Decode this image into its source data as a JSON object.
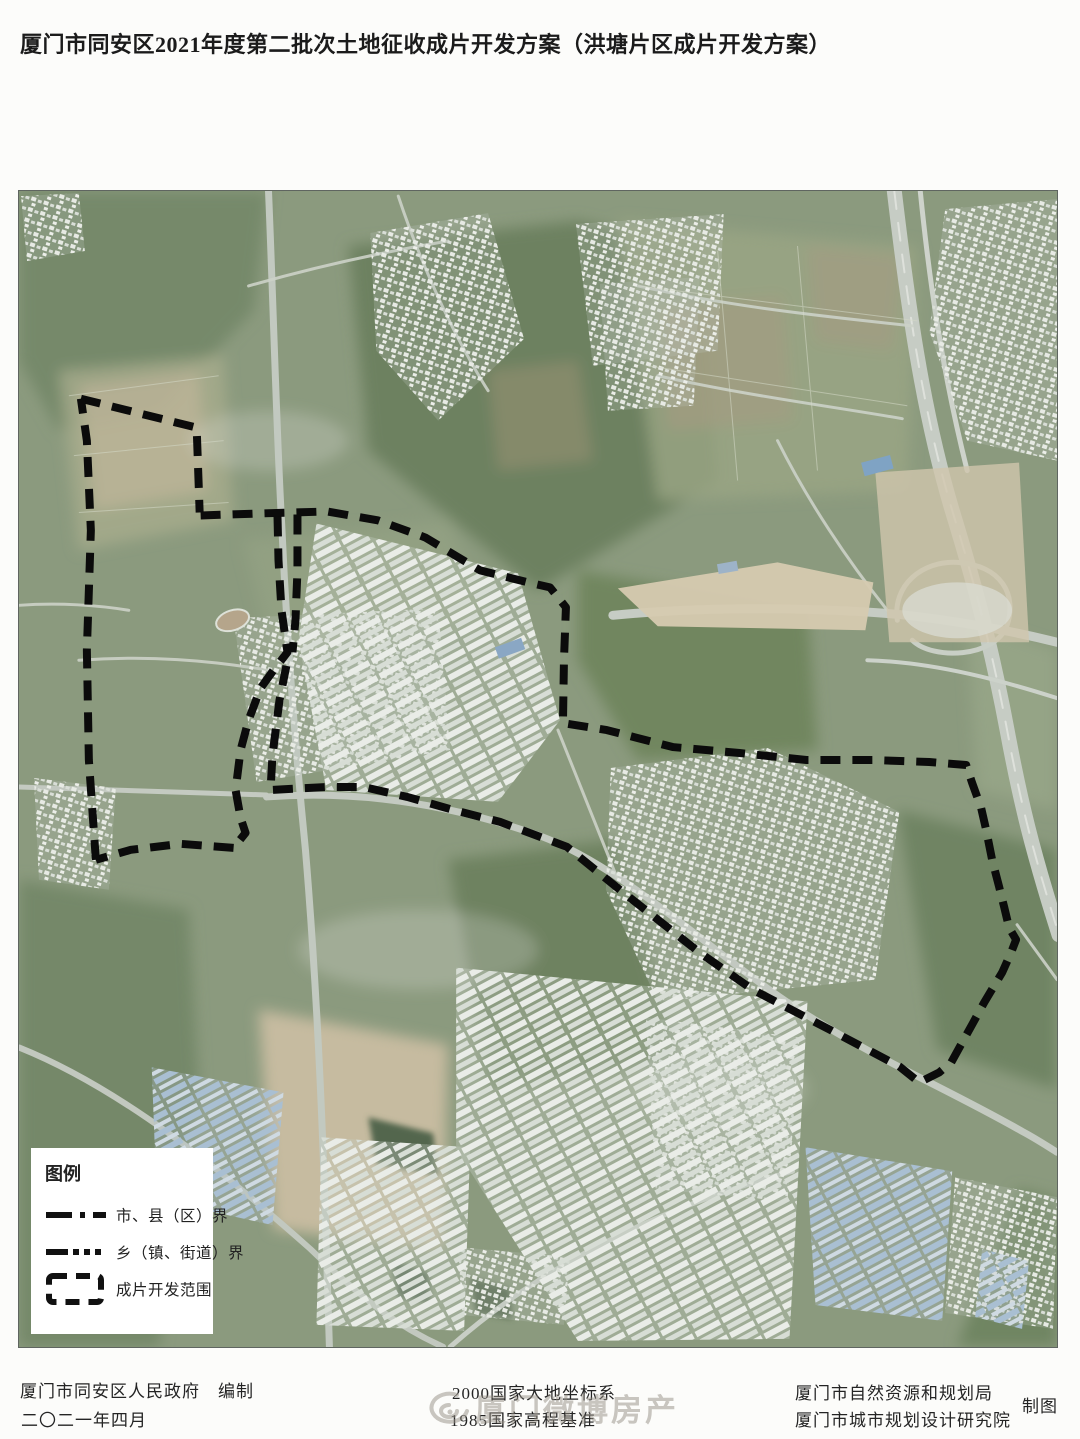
{
  "page": {
    "title": "厦门市同安区2021年度第二批次土地征收成片开发方案（洪塘片区成片开发方案）"
  },
  "legend": {
    "title": "图例",
    "items": [
      {
        "symbol": "dash-dot-line",
        "label": "市、县（区）界"
      },
      {
        "symbol": "dense-dash-line",
        "label": "乡（镇、街道）界"
      },
      {
        "symbol": "thick-dash-rect",
        "label": "成片开发范围"
      }
    ]
  },
  "footer": {
    "compiler": "厦门市同安区人民政府　编制",
    "date": "二〇二一年四月",
    "coordinate_system": "2000国家大地坐标系",
    "elevation_datum": "1985国家高程基准",
    "resource_bureau": "厦门市自然资源和规划局",
    "planning_institute": "厦门市城市规划设计研究院",
    "cartography": "制图"
  },
  "watermark": {
    "text": "厦门微博房产"
  },
  "map": {
    "boundary_color": "#0b0b0b",
    "boundary_paths": [
      [
        [
          62,
          208
        ],
        [
          178,
          237
        ],
        [
          181,
          322
        ]
      ],
      [
        [
          182,
          325
        ],
        [
          240,
          323
        ],
        [
          309,
          321
        ],
        [
          360,
          330
        ],
        [
          407,
          347
        ],
        [
          462,
          380
        ],
        [
          510,
          392
        ],
        [
          532,
          397
        ],
        [
          548,
          417
        ],
        [
          546,
          470
        ],
        [
          545,
          533
        ],
        [
          589,
          540
        ],
        [
          655,
          557
        ],
        [
          722,
          563
        ],
        [
          789,
          570
        ],
        [
          855,
          570
        ],
        [
          912,
          572
        ],
        [
          949,
          575
        ],
        [
          955,
          593
        ],
        [
          964,
          618
        ],
        [
          969,
          640
        ],
        [
          975,
          670
        ],
        [
          982,
          697
        ],
        [
          987,
          717
        ],
        [
          992,
          738
        ],
        [
          999,
          750
        ],
        [
          994,
          763
        ],
        [
          985,
          783
        ],
        [
          967,
          813
        ],
        [
          955,
          835
        ],
        [
          945,
          853
        ],
        [
          934,
          873
        ],
        [
          922,
          883
        ],
        [
          902,
          893
        ],
        [
          882,
          877
        ],
        [
          812,
          840
        ],
        [
          735,
          800
        ],
        [
          682,
          763
        ],
        [
          602,
          700
        ],
        [
          549,
          657
        ],
        [
          482,
          632
        ],
        [
          435,
          620
        ],
        [
          389,
          607
        ],
        [
          345,
          597
        ],
        [
          309,
          597
        ],
        [
          252,
          600
        ],
        [
          254,
          565
        ],
        [
          261,
          510
        ],
        [
          269,
          470
        ]
      ],
      [
        [
          259,
          326
        ],
        [
          260,
          370
        ],
        [
          263,
          420
        ],
        [
          269,
          462
        ],
        [
          255,
          480
        ],
        [
          242,
          498
        ],
        [
          230,
          530
        ],
        [
          222,
          560
        ],
        [
          217,
          600
        ],
        [
          222,
          628
        ],
        [
          227,
          643
        ],
        [
          215,
          658
        ]
      ],
      [
        [
          279,
          324
        ],
        [
          279,
          380
        ],
        [
          277,
          430
        ],
        [
          274,
          462
        ]
      ],
      [
        [
          215,
          658
        ],
        [
          162,
          654
        ],
        [
          112,
          660
        ],
        [
          77,
          670
        ]
      ],
      [
        [
          77,
          670
        ],
        [
          70,
          570
        ],
        [
          68,
          460
        ],
        [
          72,
          340
        ],
        [
          68,
          250
        ],
        [
          62,
          208
        ]
      ]
    ]
  }
}
